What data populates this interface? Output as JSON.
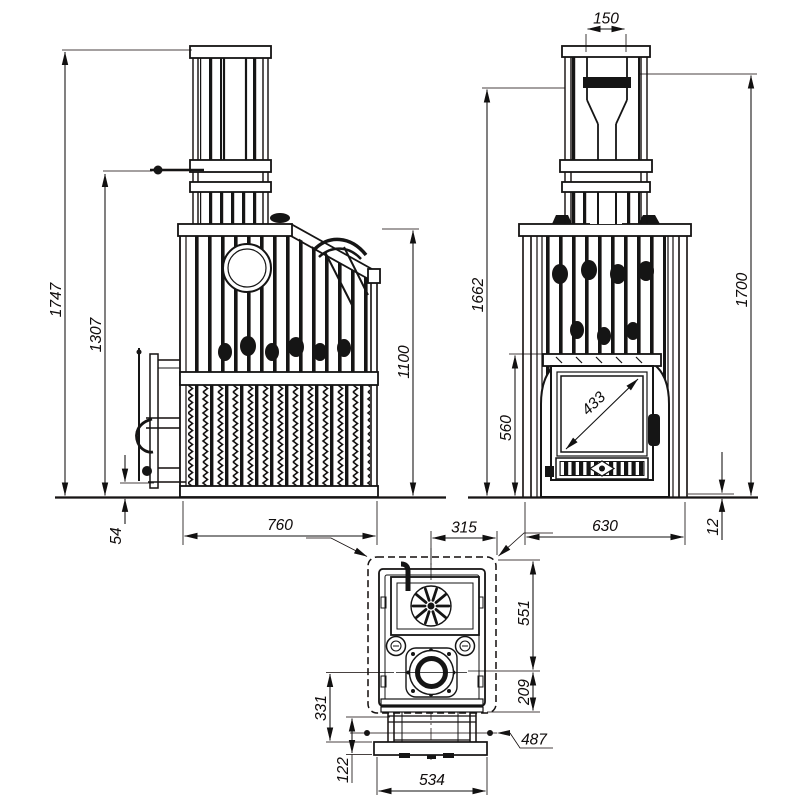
{
  "side_view": {
    "overall_height": "1747",
    "damper_height": "1307",
    "door_bottom_clearance": "54",
    "depth": "760",
    "cage_height": "1100"
  },
  "front_view": {
    "flue_pipe_width": "150",
    "height_to_pipe_left": "1662",
    "height_to_pipe_right": "1700",
    "door_arch_height": "560",
    "door_glass_diagonal": "433",
    "width": "630",
    "base_plate_thickness": "12"
  },
  "top_view": {
    "flue_center_to_edge": "315",
    "rear_section_depth": "551",
    "mid_section_depth": "209",
    "front_section_depth": "331",
    "front_lip": "122",
    "front_width": "534",
    "handle_span": "487"
  }
}
